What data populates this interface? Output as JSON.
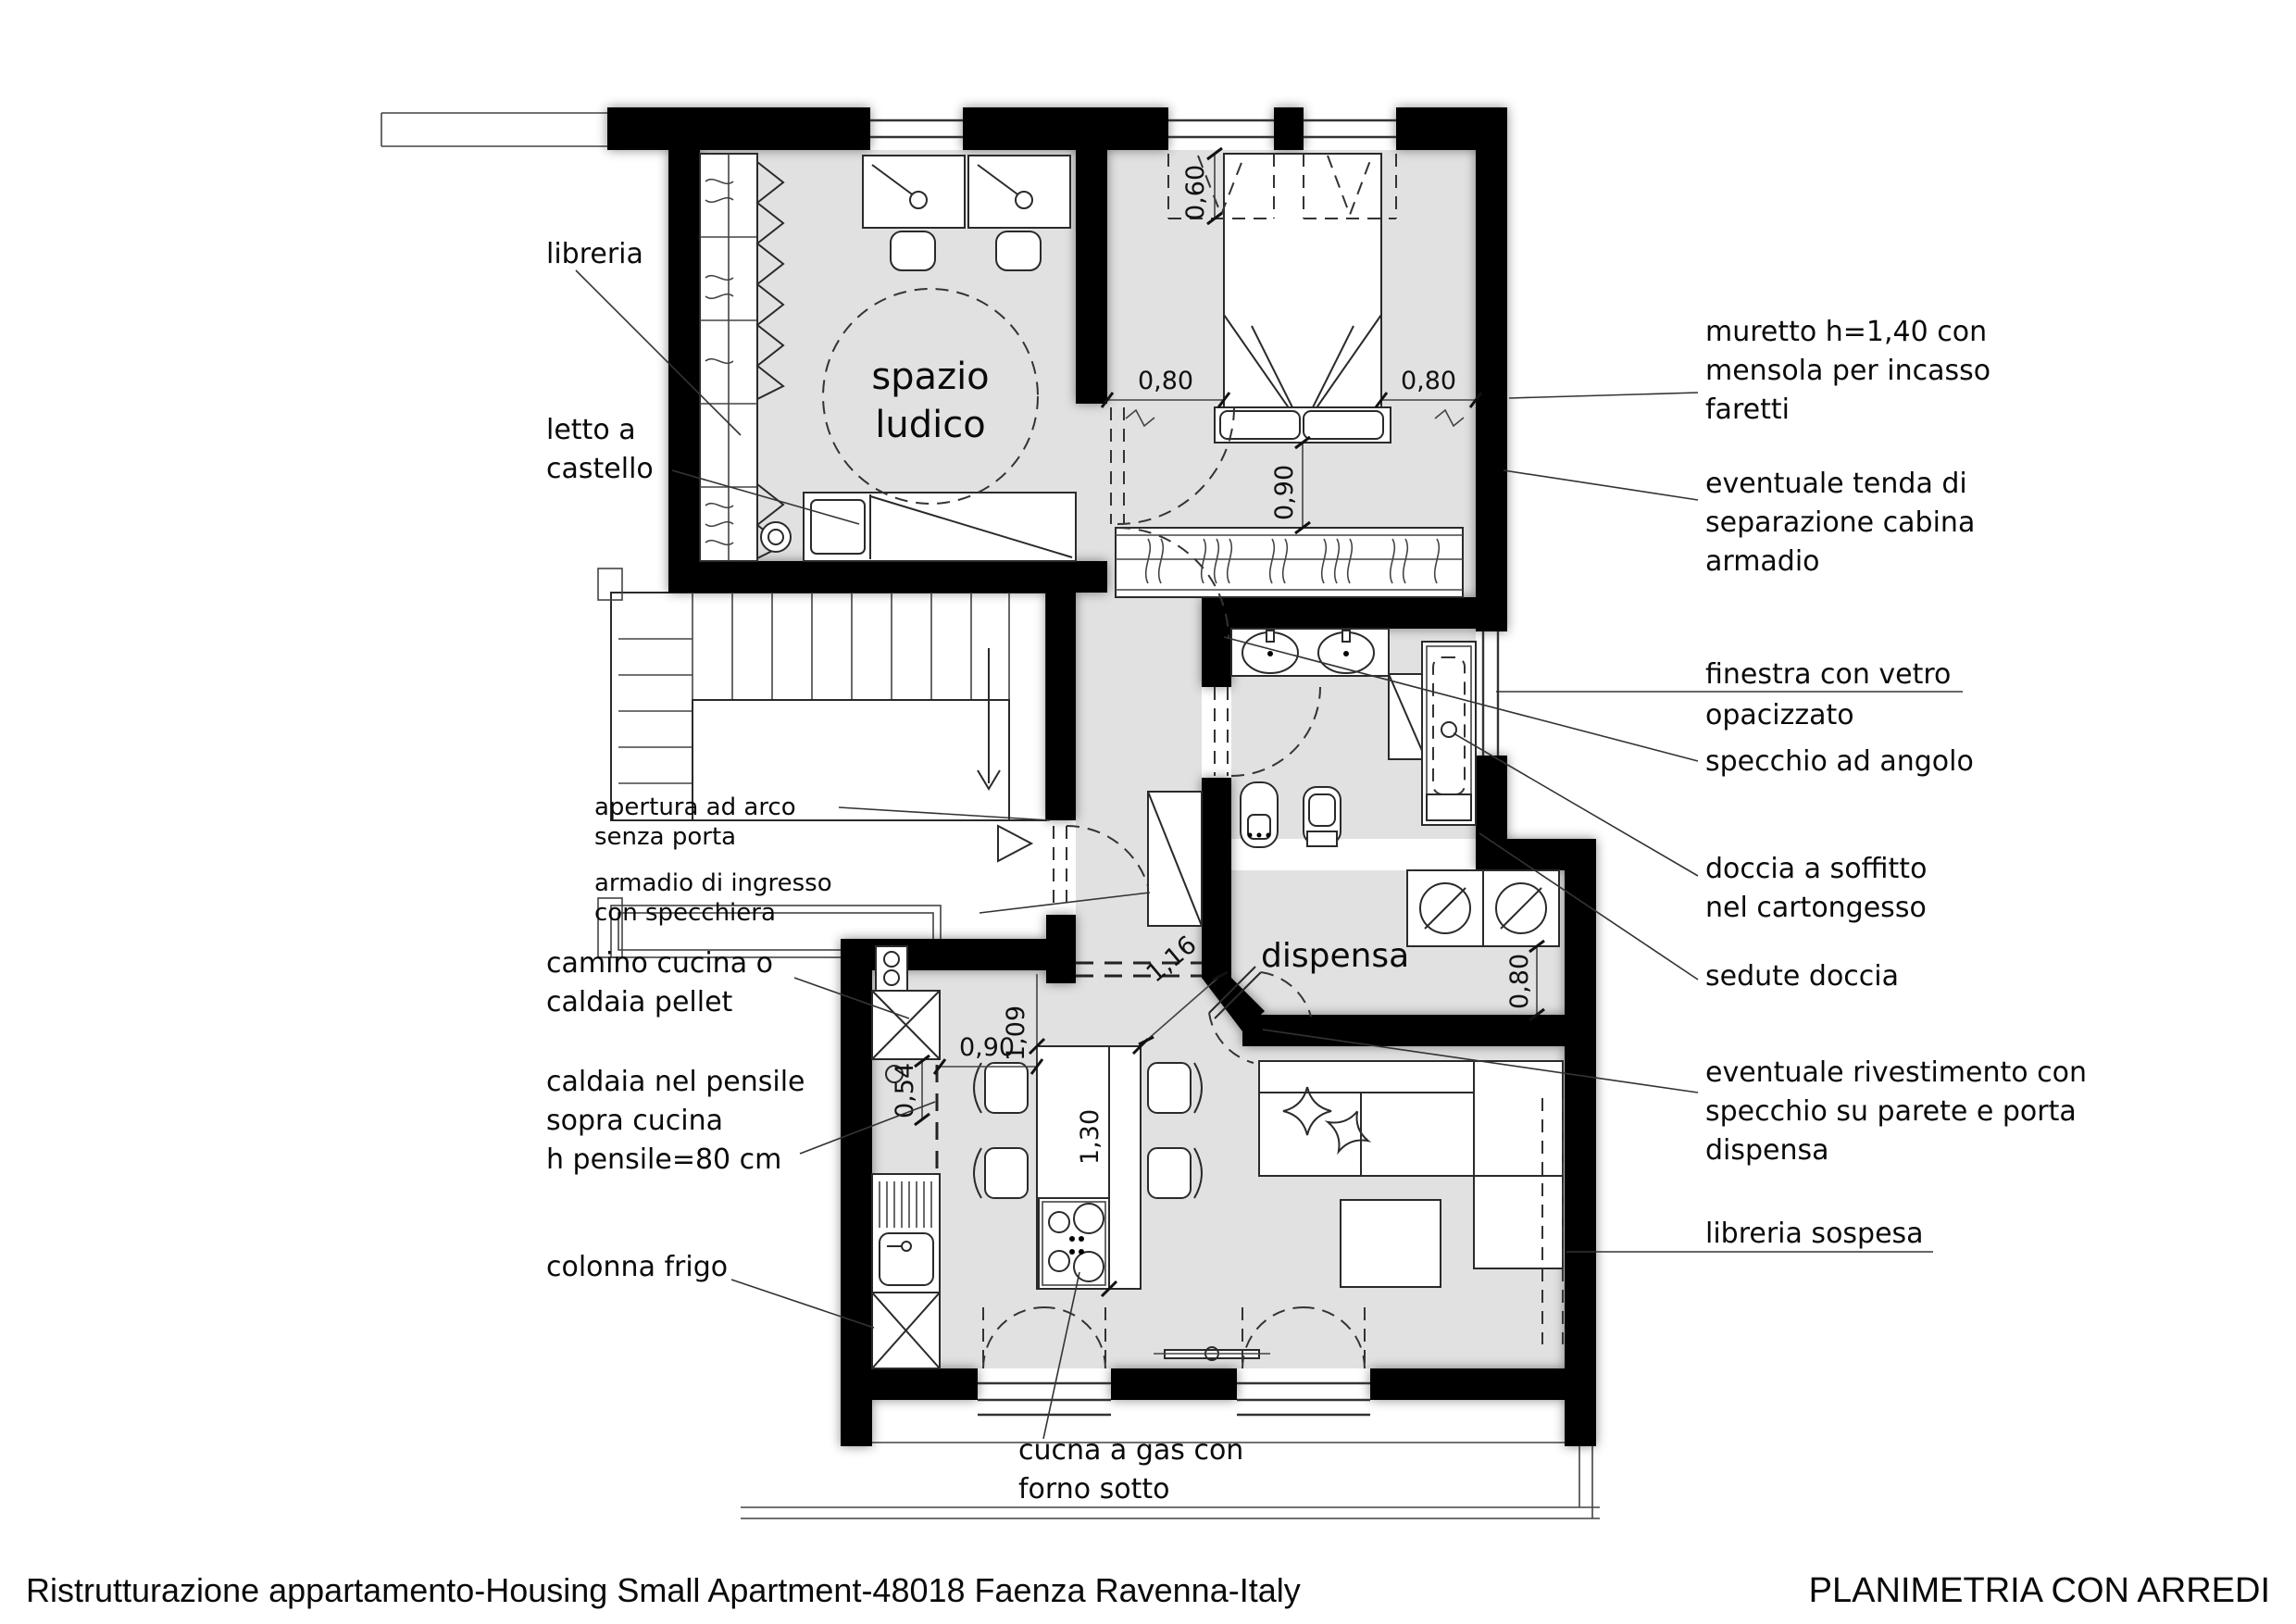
{
  "colors": {
    "wall": "#000000",
    "floor": "#e1e1e1",
    "line": "#2a2a2a"
  },
  "rooms": {
    "spazio1": "spazio",
    "spazio2": "ludico",
    "dispensa": "dispensa"
  },
  "labels": {
    "libreria": "libreria",
    "letto1": "letto a",
    "letto2": "castello",
    "apertura1": "apertura ad arco",
    "apertura2": "senza porta",
    "armadio1": "armadio di ingresso",
    "armadio2": "con  specchiera",
    "camino1": "camino cucina o",
    "camino2": "caldaia pellet",
    "caldaia1": "caldaia nel pensile",
    "caldaia2": "sopra cucina",
    "caldaia3": "h pensile=80 cm",
    "colonna": "colonna frigo",
    "cucina1": "cucna a gas con",
    "cucina2": "forno sotto",
    "muretto1": "muretto h=1,40 con",
    "muretto2": "mensola per incasso",
    "muretto3": "faretti",
    "tenda1": "eventuale tenda di",
    "tenda2": "separazione cabina",
    "tenda3": "armadio",
    "finestra1": "finestra con vetro",
    "finestra2": "opacizzato",
    "specchio": "specchio ad angolo",
    "doccia1": "doccia a soffitto",
    "doccia2": "nel cartongesso",
    "sedute": "sedute doccia",
    "rivest1": "eventuale rivestimento con",
    "rivest2": "specchio su parete e porta",
    "rivest3": "dispensa",
    "librsosp": "libreria sospesa"
  },
  "dims": {
    "d060": "0,60",
    "d080l": "0,80",
    "d080r": "0,80",
    "d090bed": "0,90",
    "d109": "1,09",
    "d090k": "0,90",
    "d054": "0,54",
    "d130": "1,30",
    "d116": "1,16",
    "d080d": "0,80"
  },
  "footer": {
    "left": "Ristrutturazione appartamento-Housing Small Apartment-48018 Faenza Ravenna-Italy",
    "right": "PLANIMETRIA CON ARREDI"
  }
}
